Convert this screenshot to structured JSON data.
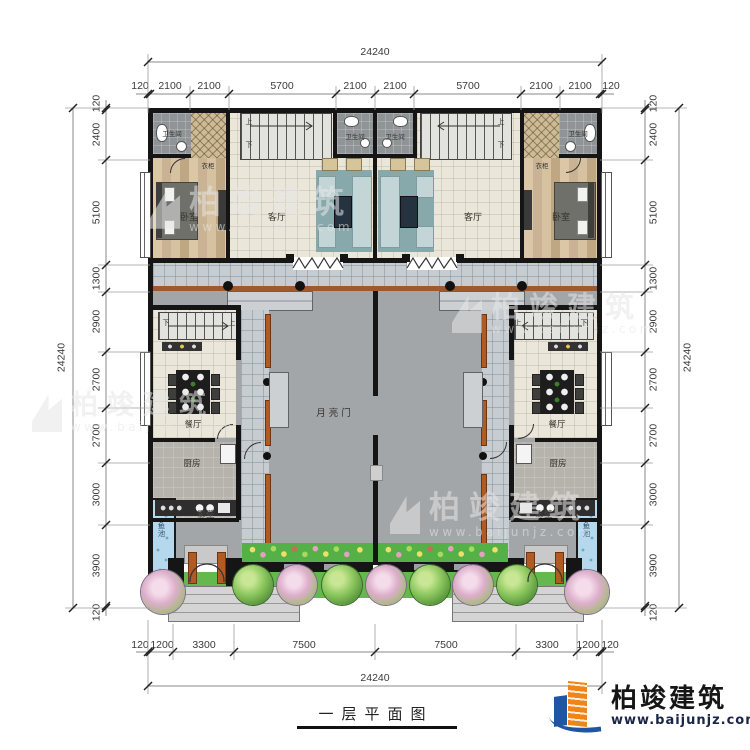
{
  "title": "一层平面图",
  "logo": {
    "company": "柏竣建筑",
    "website": "www.baijunjz.com"
  },
  "watermark": {
    "company": "柏竣建筑",
    "website": "www.baijunjz.com"
  },
  "rooms": {
    "bedroom": "卧室",
    "living": "客厅",
    "bathroom": "卫生间",
    "wardrobe": "衣柜",
    "dining": "餐厅",
    "kitchen": "厨房",
    "moon_gate": "月亮门",
    "screen_wall": "影壁",
    "fish_pond": "鱼池",
    "up": "上",
    "down": "下"
  },
  "dims": {
    "overall": "24240",
    "top": [
      "120",
      "2100",
      "2100",
      "5700",
      "2100",
      "2100",
      "5700",
      "2100",
      "2100",
      "120"
    ],
    "bottom": [
      "120",
      "1200",
      "3300",
      "7500",
      "7500",
      "3300",
      "1200",
      "120"
    ],
    "left": [
      "120",
      "2400",
      "5100",
      "1300",
      "2900",
      "2700",
      "2700",
      "3000",
      "3900",
      "120"
    ],
    "right": [
      "120",
      "2400",
      "5100",
      "1300",
      "2900",
      "2700",
      "2700",
      "3000",
      "3900",
      "120"
    ]
  },
  "colors": {
    "wall": "#151515",
    "accent_orange": "#ef8519",
    "accent_blue": "#1e55a4",
    "garden_green": "#58b14a",
    "pond_blue": "#b6d8ec",
    "courtyard_gray": "#a3a6a9"
  }
}
